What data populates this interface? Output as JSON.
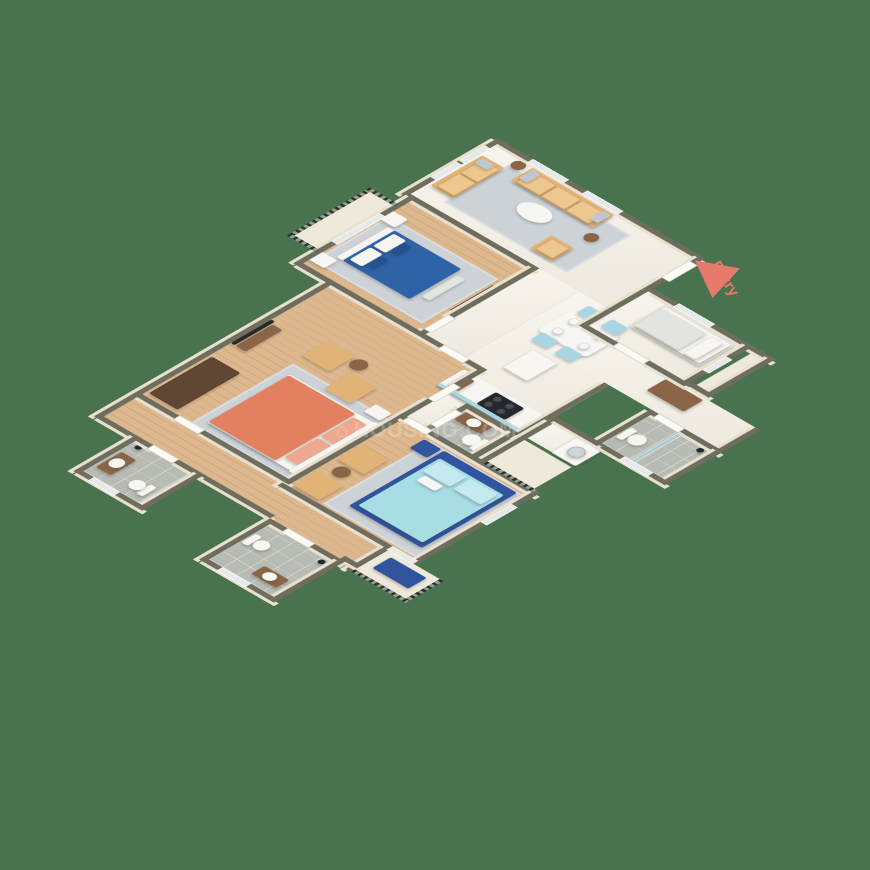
{
  "background_color": "#49734f",
  "entry_marker": {
    "label": "Entry",
    "color": "#e87a6d",
    "icon": "entry-arrow-triangle"
  },
  "watermark": {
    "logo_glyph": "⌂",
    "text": "HOUSING.COM"
  },
  "palette": {
    "wall_top": "#6f6e5e",
    "wall_face": "#e9e1d0",
    "marble_floor": "#f3efe5",
    "wood_floor": "#ddb88e",
    "bathroom_tile": "#b7bbb4",
    "rug_gray": "#cdd2d7",
    "sofa_tan": "#e2b377",
    "bed_blue": "#2e63a7",
    "bed_coral": "#e2805f",
    "bed_cyan": "#a9dde6",
    "bed_frame_navy": "#30549e",
    "dining_chair_blue": "#a9d6e4",
    "wardrobe_brown": "#5f4734",
    "railing_black": "#2f2f2d"
  },
  "scene": {
    "type": "3d-isometric-floor-plan",
    "rooms": [
      {
        "name": "living-room",
        "floor": "marble",
        "furniture": [
          "three-seat-sofa",
          "two-seat-sofa",
          "armchair",
          "round-coffee-table",
          "side-tables",
          "gray-rug",
          "windows"
        ]
      },
      {
        "name": "bedroom-blue",
        "floor": "wood",
        "furniture": [
          "double-bed-blue",
          "nightstands",
          "wall-tv",
          "bench",
          "gray-rug",
          "balcony-sliding-door"
        ]
      },
      {
        "name": "bedroom-coral",
        "floor": "wood",
        "furniture": [
          "double-bed-coral",
          "wardrobe",
          "tv-console",
          "two-accent-chairs",
          "round-side-table",
          "nightstand",
          "gray-rug"
        ]
      },
      {
        "name": "bedroom-cyan",
        "floor": "wood",
        "furniture": [
          "double-bed-cyan",
          "blue-nightstand",
          "two-accent-chairs",
          "round-side-table",
          "gray-rug",
          "balcony-bench-navy"
        ]
      },
      {
        "name": "bedroom-single",
        "floor": "marble",
        "furniture": [
          "single-bed-white",
          "brown-bench"
        ]
      },
      {
        "name": "kitchen",
        "floor": "marble",
        "furniture": [
          "refrigerator",
          "hob-counter",
          "cutting-board",
          "blue-cabinet-front"
        ]
      },
      {
        "name": "dining",
        "floor": "marble",
        "furniture": [
          "dining-table",
          "four-blue-chairs",
          "plates"
        ]
      },
      {
        "name": "bathroom-left",
        "floor": "tile",
        "furniture": [
          "toilet",
          "vanity-sink",
          "shower-head"
        ]
      },
      {
        "name": "bathroom-bottom",
        "floor": "tile",
        "furniture": [
          "toilet",
          "vanity-sink",
          "shower-head"
        ]
      },
      {
        "name": "bathroom-middle",
        "floor": "tile",
        "furniture": [
          "toilet",
          "wood-vanity-sink"
        ]
      },
      {
        "name": "bathroom-east",
        "floor": "tile",
        "furniture": [
          "toilet",
          "shower-glass",
          "shower-head"
        ]
      },
      {
        "name": "balcony-northwest",
        "floor": "cream",
        "furniture": [
          "iron-railing"
        ]
      },
      {
        "name": "balcony-service",
        "floor": "cream",
        "furniture": [
          "washing-machine",
          "iron-railing"
        ]
      },
      {
        "name": "balcony-southeast",
        "floor": "cream",
        "furniture": [
          "navy-bench",
          "iron-railing"
        ]
      }
    ]
  }
}
